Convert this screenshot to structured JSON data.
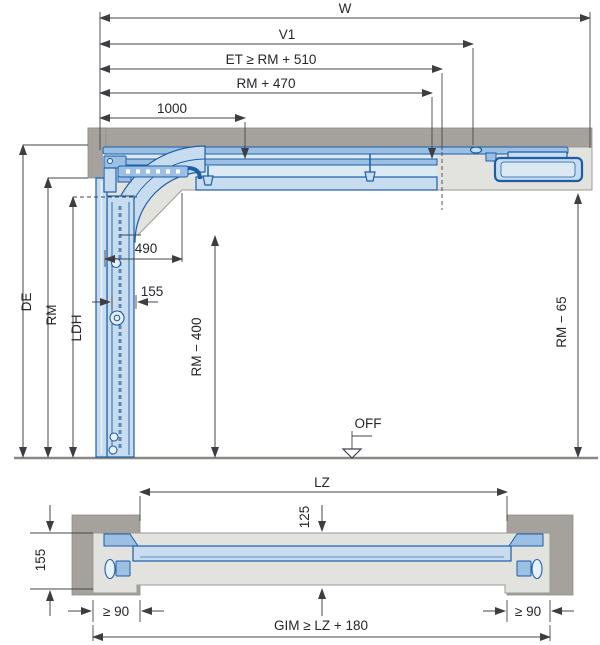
{
  "diagram_type": "sectional-door-installation-drawing",
  "side_view": {
    "dim_w": "W",
    "dim_v1": "V1",
    "dim_et": "ET ≥ RM + 510",
    "dim_rm470": "RM + 470",
    "dim_1000": "1000",
    "dim_490": "490",
    "dim_155": "155",
    "dim_de": "DE",
    "dim_rm": "RM",
    "dim_ldh": "LDH",
    "dim_rm_minus_400": "RM − 400",
    "dim_rm_minus_65": "RM − 65",
    "label_off": "OFF"
  },
  "plan_view": {
    "dim_lz": "LZ",
    "dim_125": "125",
    "dim_155": "155",
    "dim_ge90_left": "≥ 90",
    "dim_ge90_right": "≥ 90",
    "dim_gim": "GIM ≥ LZ + 180"
  },
  "colors": {
    "track_blue_stroke": "#1d5ea7",
    "track_fill_light": "#c7dcef",
    "track_fill_medium": "#9cc0e4",
    "wall_dark_gray": "#a5a29d",
    "frame_light_gray": "#e2e2df",
    "dimension_line": "#45454a",
    "text": "#26262b",
    "floor_line": "#8a8880"
  }
}
